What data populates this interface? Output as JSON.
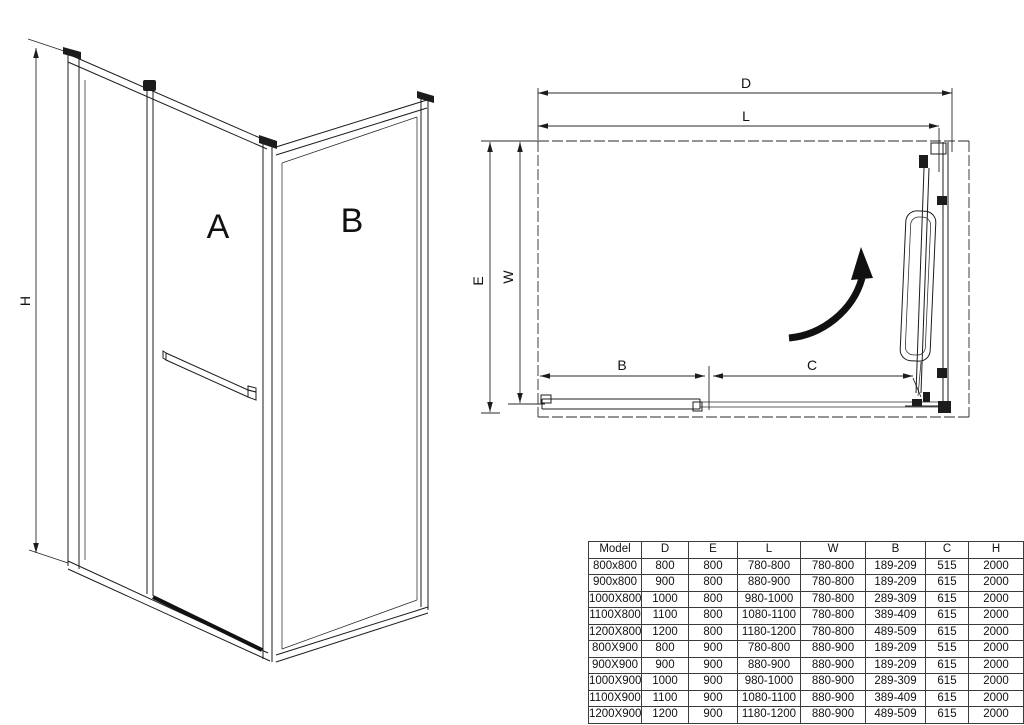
{
  "drawing": {
    "iso": {
      "height_label": "H",
      "panel_a_label": "A",
      "panel_b_label": "B"
    },
    "plan": {
      "total_width_label": "D",
      "adjust_width_label": "L",
      "total_depth_label": "E",
      "inner_depth_label": "W",
      "fixed_panel_label": "B",
      "opening_label": "C"
    }
  },
  "table": {
    "columns": [
      "Model",
      "D",
      "E",
      "L",
      "W",
      "B",
      "C",
      "H"
    ],
    "rows": [
      [
        "800x800",
        "800",
        "800",
        "780-800",
        "780-800",
        "189-209",
        "515",
        "2000"
      ],
      [
        "900x800",
        "900",
        "800",
        "880-900",
        "780-800",
        "189-209",
        "615",
        "2000"
      ],
      [
        "1000X800",
        "1000",
        "800",
        "980-1000",
        "780-800",
        "289-309",
        "615",
        "2000"
      ],
      [
        "1100X800",
        "1100",
        "800",
        "1080-1100",
        "780-800",
        "389-409",
        "615",
        "2000"
      ],
      [
        "1200X800",
        "1200",
        "800",
        "1180-1200",
        "780-800",
        "489-509",
        "615",
        "2000"
      ],
      [
        "800X900",
        "800",
        "900",
        "780-800",
        "880-900",
        "189-209",
        "515",
        "2000"
      ],
      [
        "900X900",
        "900",
        "900",
        "880-900",
        "880-900",
        "189-209",
        "615",
        "2000"
      ],
      [
        "1000X900",
        "1000",
        "900",
        "980-1000",
        "880-900",
        "289-309",
        "615",
        "2000"
      ],
      [
        "1100X900",
        "1100",
        "900",
        "1080-1100",
        "880-900",
        "389-409",
        "615",
        "2000"
      ],
      [
        "1200X900",
        "1200",
        "900",
        "1180-1200",
        "880-900",
        "489-509",
        "615",
        "2000"
      ]
    ]
  },
  "colors": {
    "line": "#1c1c1c",
    "background": "#ffffff"
  }
}
